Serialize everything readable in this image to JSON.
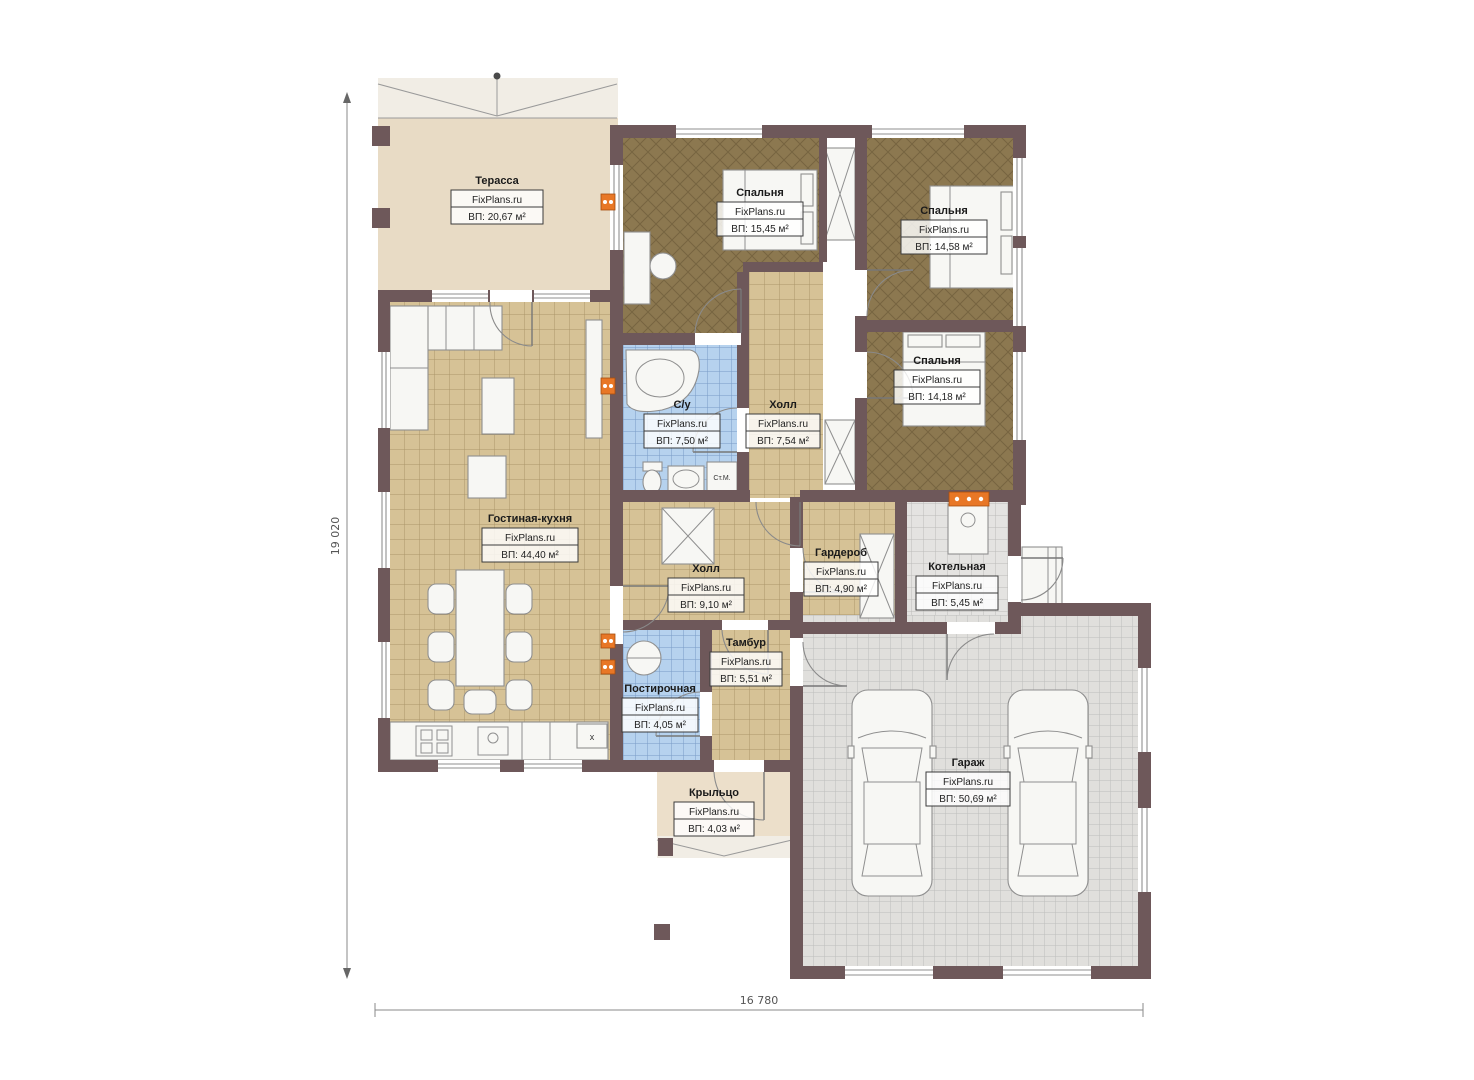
{
  "plan_title": "Floor plan (one-storey house with garage)",
  "brand": "FixPlans.ru",
  "dimensions": {
    "vertical": "19 020",
    "horizontal": "16 780"
  },
  "rooms": [
    {
      "name": "Терасса",
      "brand": "FixPlans.ru",
      "area": "ВП: 20,67 м²"
    },
    {
      "name": "Спальня",
      "brand": "FixPlans.ru",
      "area": "ВП: 15,45 м²"
    },
    {
      "name": "Спальня",
      "brand": "FixPlans.ru",
      "area": "ВП: 14,58 м²"
    },
    {
      "name": "Спальня",
      "brand": "FixPlans.ru",
      "area": "ВП: 14,18 м²"
    },
    {
      "name": "С/у",
      "brand": "FixPlans.ru",
      "area": "ВП: 7,50 м²"
    },
    {
      "name": "Холл",
      "brand": "FixPlans.ru",
      "area": "ВП: 7,54 м²"
    },
    {
      "name": "Гостиная-кухня",
      "brand": "FixPlans.ru",
      "area": "ВП: 44,40 м²"
    },
    {
      "name": "Холл",
      "brand": "FixPlans.ru",
      "area": "ВП: 9,10 м²"
    },
    {
      "name": "Гардероб",
      "brand": "FixPlans.ru",
      "area": "ВП: 4,90 м²"
    },
    {
      "name": "Котельная",
      "brand": "FixPlans.ru",
      "area": "ВП: 5,45 м²"
    },
    {
      "name": "Тамбур",
      "brand": "FixPlans.ru",
      "area": "ВП: 5,51 м²"
    },
    {
      "name": "Постирочная",
      "brand": "FixPlans.ru",
      "area": "ВП: 4,05 м²"
    },
    {
      "name": "Крыльцо",
      "brand": "FixPlans.ru",
      "area": "ВП: 4,03 м²"
    },
    {
      "name": "Гараж",
      "brand": "FixPlans.ru",
      "area": "ВП: 50,69 м²"
    }
  ],
  "annotations": {
    "washing_machine": "Ст.М.",
    "kitchen_mark": "х"
  },
  "colors": {
    "wall": "#6e585a",
    "floor_wood": "#8c7850",
    "floor_tile_tan": "#d6c296",
    "floor_tile_blue": "#b6d2ee",
    "floor_tile_gray": "#e4e3e1",
    "terrace": "#e8dbc5",
    "radiator": "#e87726"
  }
}
